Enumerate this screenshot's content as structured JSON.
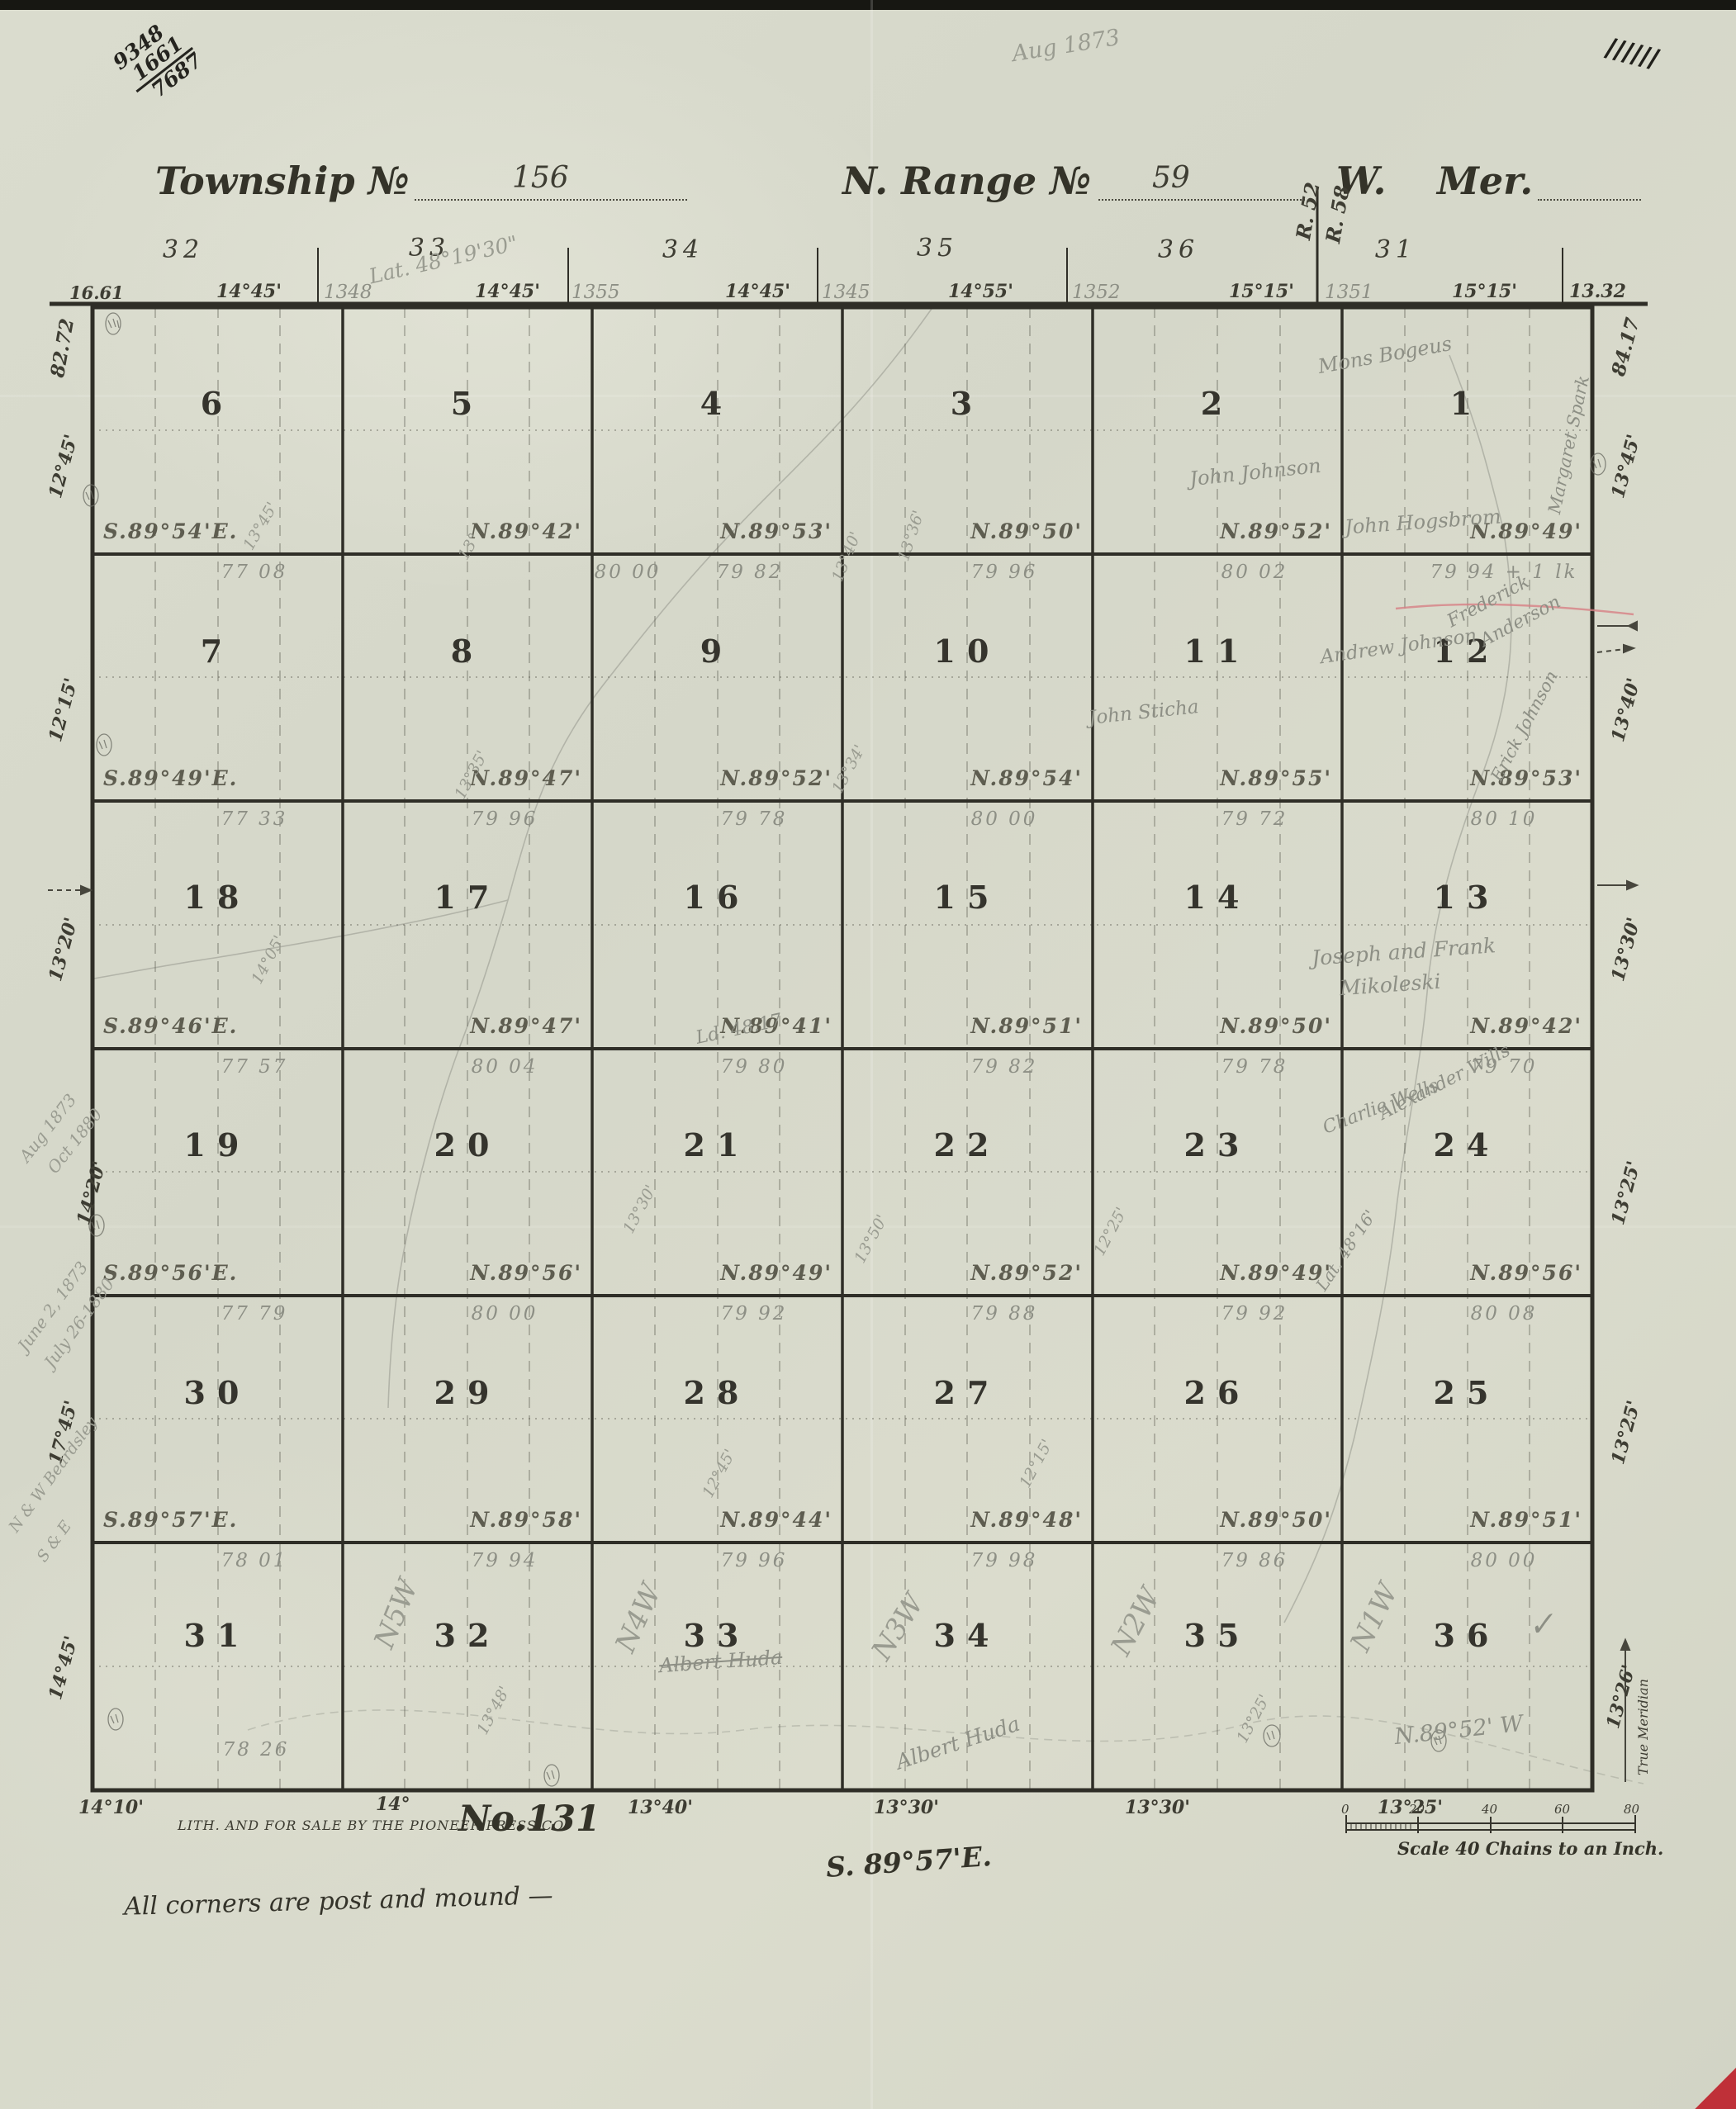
{
  "meta": {
    "registry": [
      "9348",
      "1661",
      "7687"
    ],
    "date_note": "Aug 1873",
    "tally": "//////"
  },
  "title": {
    "township_label": "Township №",
    "township_no": "156",
    "range_label": "N. Range №",
    "range_no": "59",
    "direction": "W.",
    "meridian": "Mer."
  },
  "header": {
    "section_numbers": [
      "32",
      "33",
      "34",
      "35",
      "36",
      "31"
    ],
    "lat_note": "Lat. 48°19'30\"",
    "range_marks": [
      "R. 52",
      "R. 58"
    ],
    "west_dist": "16.61",
    "east_dist": "13.32",
    "bearings": [
      "14°45'",
      "14°45'",
      "14°45'",
      "14°55'",
      "15°15'",
      "15°15'"
    ],
    "pencil_chains": [
      "1348",
      "1355",
      "1345",
      "1352",
      "1351"
    ]
  },
  "grid": {
    "rows": [
      [
        "6",
        "5",
        "4",
        "3",
        "2",
        "1"
      ],
      [
        "7",
        "8",
        "9",
        "10",
        "11",
        "12"
      ],
      [
        "18",
        "17",
        "16",
        "15",
        "14",
        "13"
      ],
      [
        "19",
        "20",
        "21",
        "22",
        "23",
        "24"
      ],
      [
        "30",
        "29",
        "28",
        "27",
        "26",
        "25"
      ],
      [
        "31",
        "32",
        "33",
        "34",
        "35",
        "36"
      ]
    ]
  },
  "bearing_lines": [
    {
      "labels": [
        "S.89°54'E.",
        "N.89°42'",
        "N.89°53'",
        "N.89°50'",
        "N.89°52'",
        "N.89°49'"
      ],
      "chains": [
        "77 08",
        "80 00",
        "79 82",
        "79 96",
        "80 02",
        "79 94 + 1 lk"
      ]
    },
    {
      "labels": [
        "S.89°49'E.",
        "N.89°47'",
        "N.89°52'",
        "N.89°54'",
        "N.89°55'",
        "N.89°53'"
      ],
      "chains": [
        "77 33",
        "79 96",
        "79 78",
        "80 00",
        "79 72",
        "80 10"
      ]
    },
    {
      "labels": [
        "S.89°46'E.",
        "N.89°47'",
        "N.89°41'",
        "N.89°51'",
        "N.89°50'",
        "N.89°42'"
      ],
      "chains": [
        "77 57",
        "80 04",
        "79 80",
        "79 82",
        "79 78",
        "79 70"
      ]
    },
    {
      "labels": [
        "S.89°56'E.",
        "N.89°56'",
        "N.89°49'",
        "N.89°52'",
        "N.89°49'",
        "N.89°56'"
      ],
      "chains": [
        "77 79",
        "80 00",
        "79 92",
        "79 88",
        "79 92",
        "80 08"
      ]
    },
    {
      "labels": [
        "S.89°57'E.",
        "N.89°58'",
        "N.89°44'",
        "N.89°48'",
        "N.89°50'",
        "N.89°51'"
      ],
      "chains": [
        "78 01",
        "79 94",
        "79 96",
        "79 98",
        "79 86",
        "80 00"
      ]
    }
  ],
  "south_line": {
    "chains_west": "78 26"
  },
  "west_margin": {
    "width_note": "82.72",
    "angles": [
      "12°45'",
      "12°15'",
      "13°20'",
      "14°20'",
      "17°45'",
      "14°45'"
    ],
    "pencil_dates": [
      "Aug 1873",
      "Oct 1880",
      "June 2, 1873",
      "July 26-1880",
      "N & W Beardsley",
      "S & E"
    ]
  },
  "east_margin": {
    "width_note": "84.17",
    "angles": [
      "13°45'",
      "13°40'",
      "13°30'",
      "13°25'",
      "13°25'",
      "13°26'"
    ],
    "true_meridian": "True Meridian"
  },
  "south_edge": {
    "angles": [
      "14°10'",
      "14°",
      "13°40'",
      "13°30'",
      "13°30'",
      "13°25'"
    ]
  },
  "footer": {
    "lith": "LITH. AND FOR SALE BY THE PIONEER PRESS CO.",
    "plate": "No.131",
    "closing_bearing": "S. 89°57'E.",
    "corners_note": "All corners are post and mound —",
    "scale_caption": "Scale 40 Chains to an Inch.",
    "scale_ticks": [
      "0",
      "20",
      "40",
      "60",
      "80"
    ]
  },
  "pencil_names": [
    {
      "t": "Mons Bogeus"
    },
    {
      "t": "John Johnson"
    },
    {
      "t": "John Hogsbrom"
    },
    {
      "t": "Margaret Spark"
    },
    {
      "t": "Frederick"
    },
    {
      "t": "Anderson"
    },
    {
      "t": "Andrew Johnson"
    },
    {
      "t": "John Sticha"
    },
    {
      "t": "Erick Johnson"
    },
    {
      "t": "Joseph and Frank"
    },
    {
      "t": "Mikoleski"
    },
    {
      "t": "Alexander Wills"
    },
    {
      "t": "Charlie Wells"
    },
    {
      "t": "Albert Huda"
    },
    {
      "t": "Albert Huda"
    },
    {
      "t": "N.89°52' W"
    },
    {
      "t": "Lat. 48°16'"
    },
    {
      "t": "Ld. 48.17"
    },
    {
      "t": "N5W"
    },
    {
      "t": "N4W"
    },
    {
      "t": "N3W"
    },
    {
      "t": "N2W"
    },
    {
      "t": "N1W"
    },
    {
      "t": "✓"
    }
  ],
  "variation_notes": [
    "13°45'",
    "13°",
    "13°40'",
    "13°36'",
    "13°35'",
    "13°34'",
    "12°45'",
    "12°25'",
    "13°50'",
    "13°48'",
    "13°25'",
    "12°15'",
    "14°05'",
    "13°30'"
  ]
}
